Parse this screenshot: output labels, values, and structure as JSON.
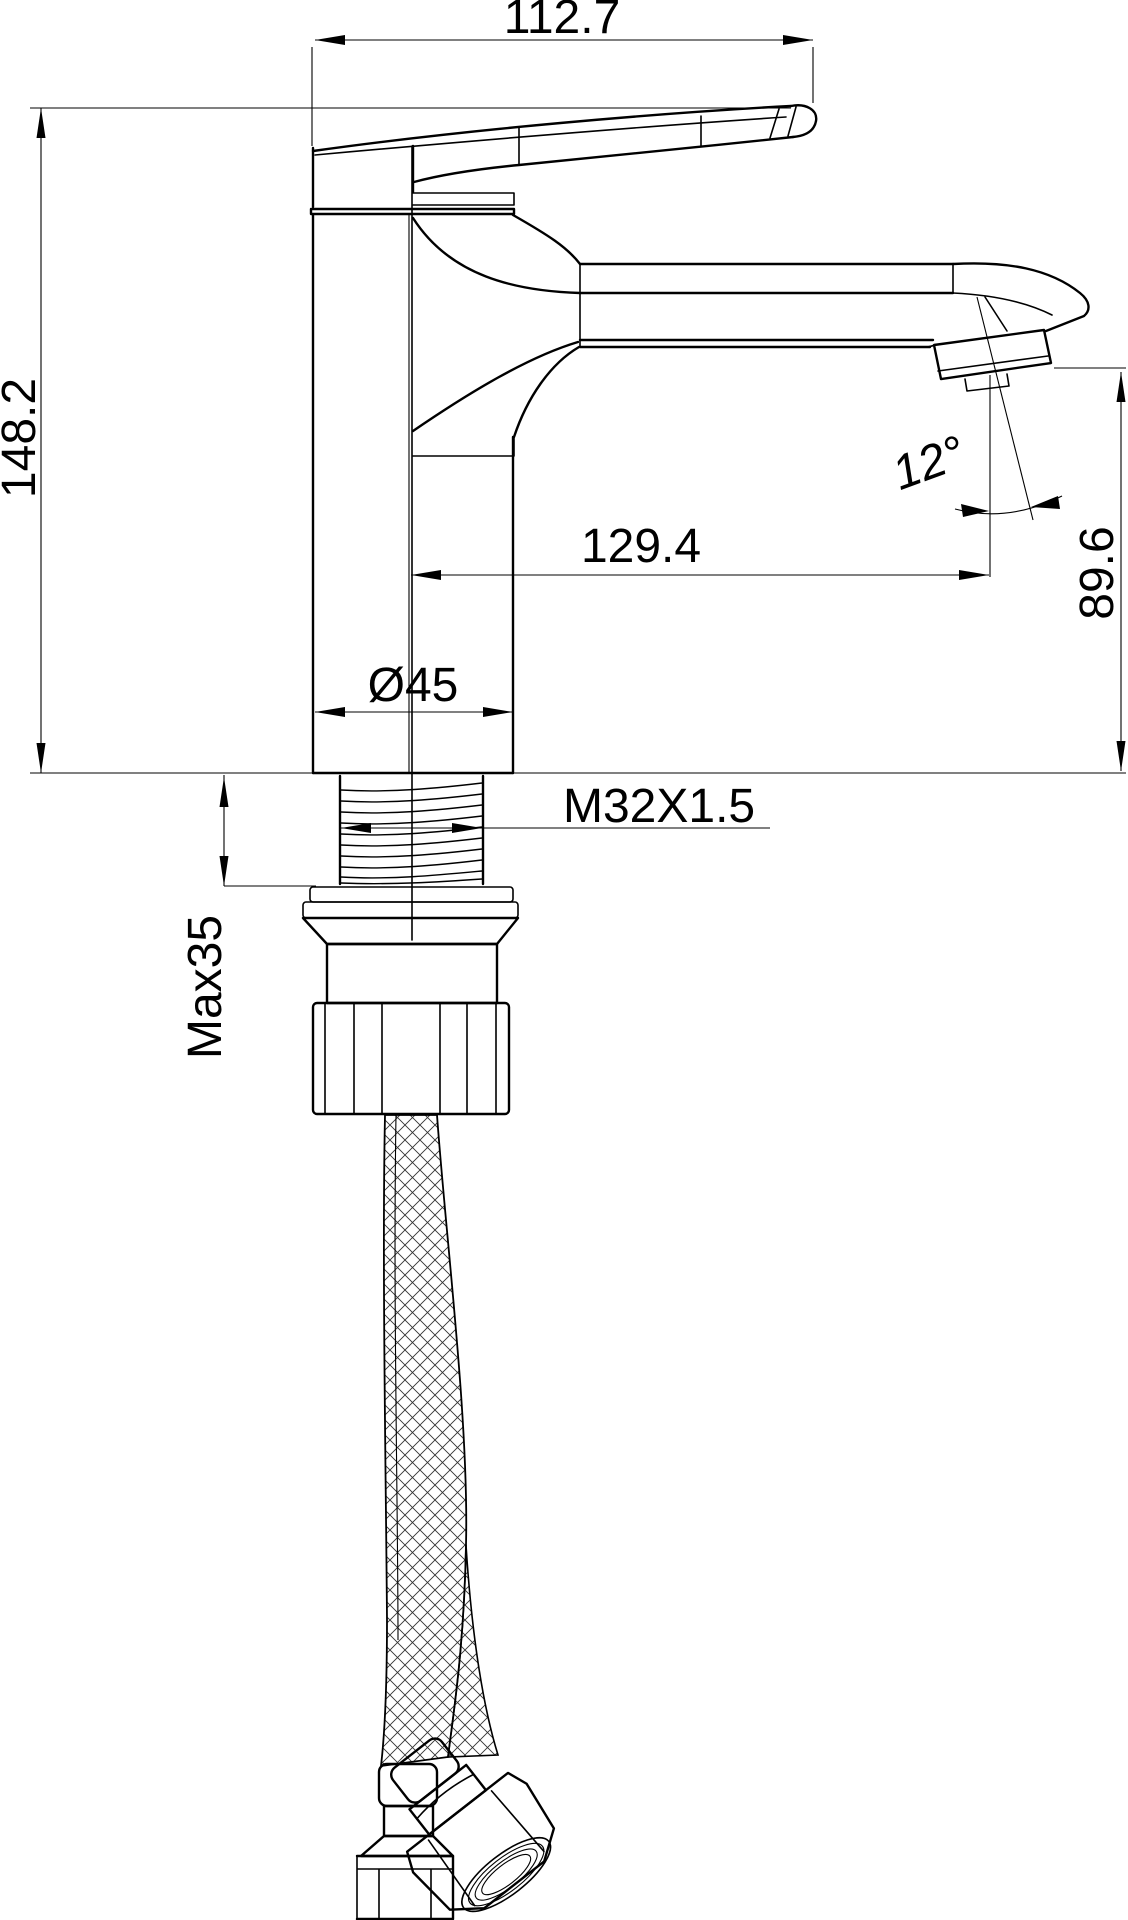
{
  "drawing": {
    "type": "technical-dimension-drawing",
    "subject": "single-lever basin mixer faucet with flexible supply hose",
    "background_color": "#ffffff",
    "line_color": "#000000",
    "dimensions": {
      "top_width": "112.7",
      "overall_height": "148.2",
      "spout_angle": "12°",
      "outlet_reach": "129.4",
      "outlet_height": "89.6",
      "body_diameter": "Ø45",
      "thread_spec": "M32X1.5",
      "max_mounting_thickness": "Max35"
    }
  }
}
